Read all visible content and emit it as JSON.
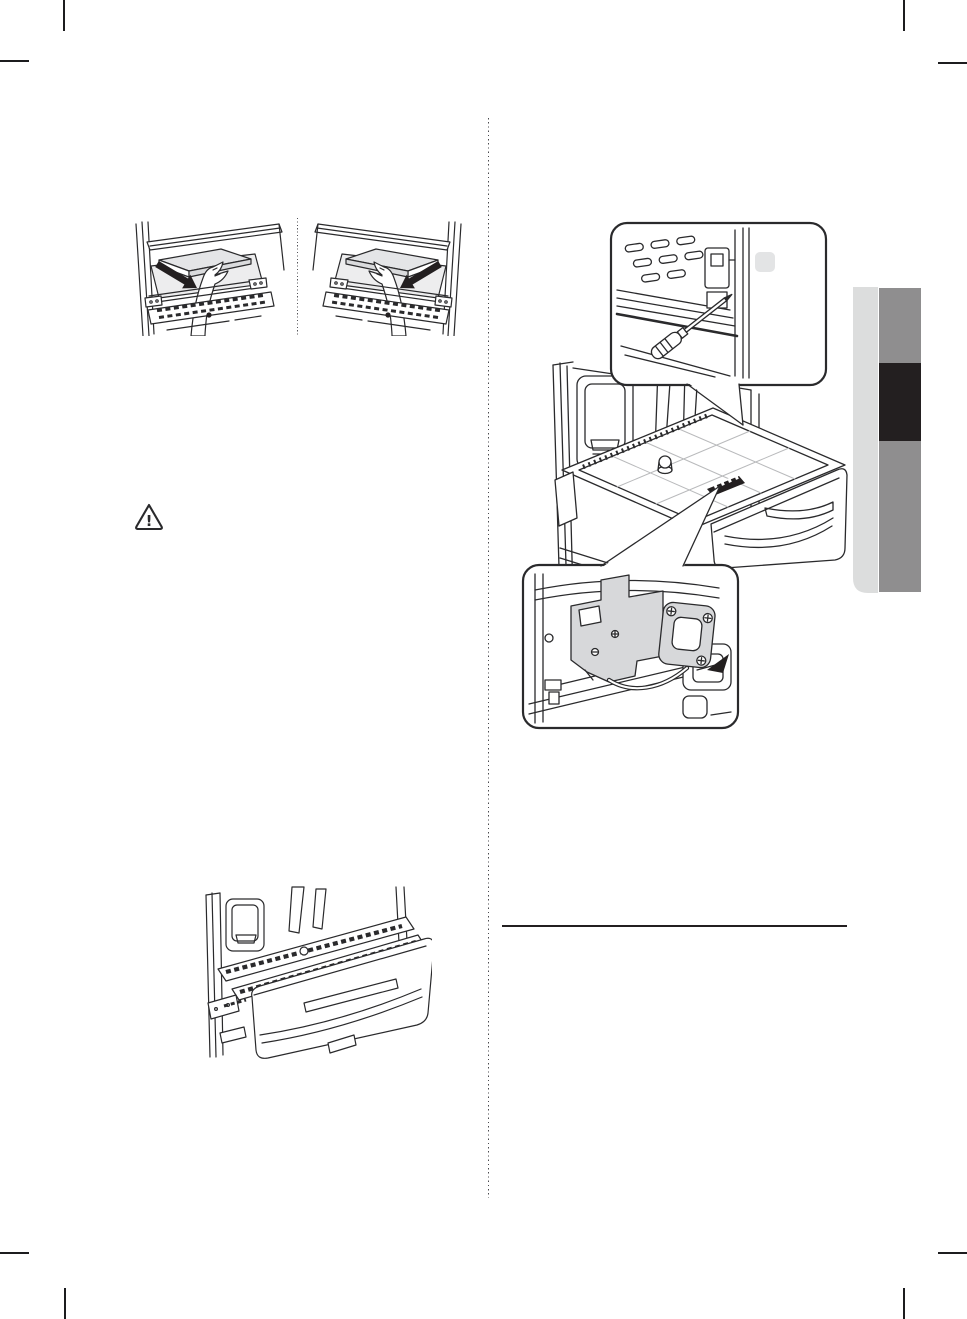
{
  "page": {
    "width": 967,
    "height": 1319,
    "background": "#ffffff"
  },
  "colors": {
    "ink": "#2a2a2c",
    "ink_strong": "#1c1c1e",
    "arrow_black": "#231f20",
    "fill_light": "#e4e5e7",
    "fill_lighter": "#ededee",
    "fill_bracket": "#d7d8da",
    "knob_gray": "#e3e4e5",
    "grid_gray": "#b9babc",
    "tab_light": "#dcdddd",
    "tab_gray": "#8f8e8f",
    "tab_dark": "#231f20",
    "rule": "#231f20"
  },
  "icons": {
    "caution_glyph": "!"
  }
}
